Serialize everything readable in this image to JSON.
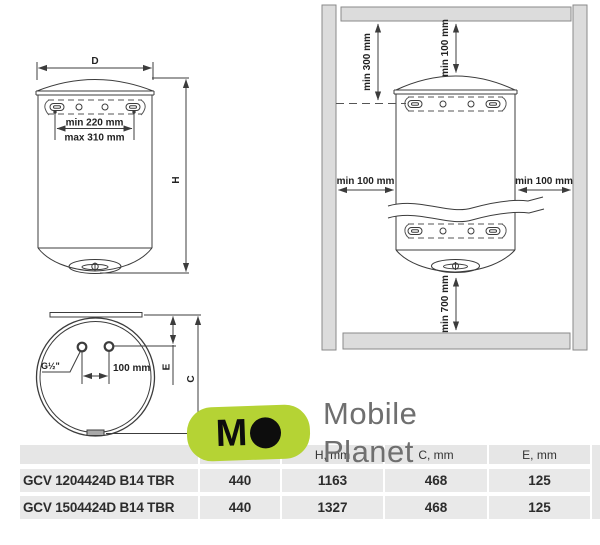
{
  "front_view": {
    "diameter_label": "D",
    "height_label": "H",
    "bracket_min_spacing": "min 220 mm",
    "bracket_max_spacing": "max 310 mm"
  },
  "bottom_view": {
    "thread_label": "G½\"",
    "pipe_spacing": "100 mm",
    "e_label": "E",
    "c_label": "C"
  },
  "installation_view": {
    "ceiling_to_bracket": "min 300 mm",
    "ceiling_to_top": "min 100 mm",
    "left_clearance": "min 100 mm",
    "right_clearance": "min 100 mm",
    "bottom_clearance": "min 700 mm"
  },
  "watermark": {
    "mark_letter": "M",
    "line1": "Mobile",
    "line2": "Planet",
    "brand_color": "#b5d334",
    "text_color": "#6f6f6f"
  },
  "table": {
    "columns": [
      "",
      "D, mm",
      "H, mm",
      "C, mm",
      "E, mm"
    ],
    "rows": [
      {
        "model": "GCV 1204424D B14 TBR",
        "d": "440",
        "h": "1163",
        "c": "468",
        "e": "125"
      },
      {
        "model": "GCV 1504424D B14 TBR",
        "d": "440",
        "h": "1327",
        "c": "468",
        "e": "125"
      }
    ]
  }
}
